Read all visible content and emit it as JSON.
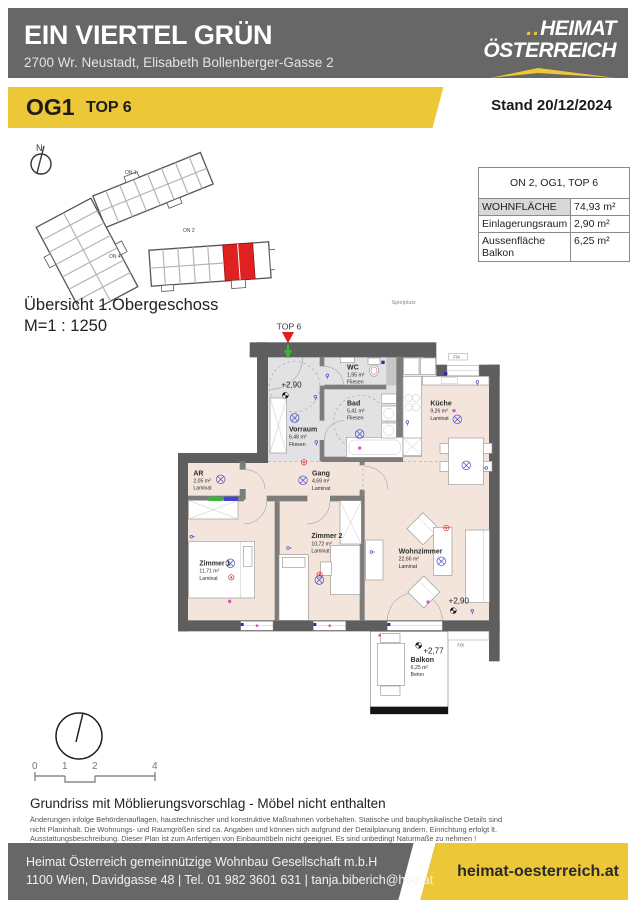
{
  "header": {
    "title": "EIN VIERTEL GRÜN",
    "subtitle": "2700 Wr. Neustadt, Elisabeth Bollenberger-Gasse 2",
    "logo": {
      "dots": "..",
      "line1": "HEIMAT",
      "line2": "ÖSTERREICH"
    }
  },
  "banner": {
    "floor": "OG1",
    "unit": "TOP 6",
    "stand": "Stand 20/12/2024"
  },
  "overview": {
    "north": "N",
    "buildings": [
      {
        "label": "ON 1"
      },
      {
        "label": "ON 2"
      },
      {
        "label": "ON 4"
      }
    ],
    "title": "Übersicht 1.Obergeschoss",
    "scale": "M=1 : 1250"
  },
  "info_table": {
    "header": "ON 2, OG1, TOP 6",
    "rows": [
      {
        "label": "WOHNFLÄCHE",
        "value": "74,93 m²"
      },
      {
        "label": "Einlagerungsraum",
        "value": "2,90 m²"
      },
      {
        "label": "Aussenfläche Balkon",
        "value": "6,25 m²"
      }
    ]
  },
  "plan": {
    "site_context": "Spielplatz",
    "unit_marker": "TOP 6",
    "levels": {
      "entry": "+2,90",
      "living": "+2,90",
      "balcony": "+2,77"
    },
    "fix_window_top": "FIX",
    "fix_window_right": "FIX",
    "rooms": [
      {
        "name": "Vorraum",
        "area": "6,48 m²",
        "floor": "Fliesen"
      },
      {
        "name": "WC",
        "area": "1,95 m²",
        "floor": "Fliesen"
      },
      {
        "name": "Bad",
        "area": "5,41 m²",
        "floor": "Fliesen"
      },
      {
        "name": "Küche",
        "area": "9,26 m²",
        "floor": "Laminat"
      },
      {
        "name": "Gang",
        "area": "4,69 m²",
        "floor": "Laminat"
      },
      {
        "name": "AR",
        "area": "2,05 m²",
        "floor": "Laminat"
      },
      {
        "name": "Zimmer 1",
        "area": "11,71 m²",
        "floor": "Laminat"
      },
      {
        "name": "Zimmer 2",
        "area": "10,72 m²",
        "floor": "Laminat"
      },
      {
        "name": "Wohnzimmer",
        "area": "22,66 m²",
        "floor": "Laminat"
      },
      {
        "name": "Balkon",
        "area": "6,25 m²",
        "floor": "Beton"
      }
    ]
  },
  "scale_bar": {
    "ticks": [
      "0",
      "1",
      "2",
      "4"
    ]
  },
  "notes": {
    "title": "Grundriss mit Möblierungsvorschlag - Möbel nicht enthalten",
    "line1": "Änderungen infolge Behördenauflagen, haustechnischer und konstruktive Maßnahmen vorbehalten. Statische und bauphysikalische Details sind",
    "line2": "nicht Planinhalt. Die Wohnungs- und Raumgrößen sind ca. Angaben und können sich aufgrund der Detailplanung ändern. Einrichtung erfolgt lt.",
    "line3": "Ausstattungsbeschreibung. Dieser Plan ist zum Anfertigen von Einbaumöbeln nicht geeignet. Es sind unbedingt Naturmaße zu nehmen !"
  },
  "footer": {
    "company": "Heimat Österreich gemeinnützige Wohnbau Gesellschaft m.b.H",
    "contact": "1100 Wien, Davidgasse 48 | Tel. 01 982 3601 631 | tanja.biberich@hoe.at",
    "website": "heimat-oesterreich.at"
  },
  "colors": {
    "brand_yellow": "#ecc737",
    "header_gray": "#676767",
    "highlight_red": "#e02121",
    "laminat": "#f3e5dc",
    "fliesen": "#e2e2e4"
  }
}
